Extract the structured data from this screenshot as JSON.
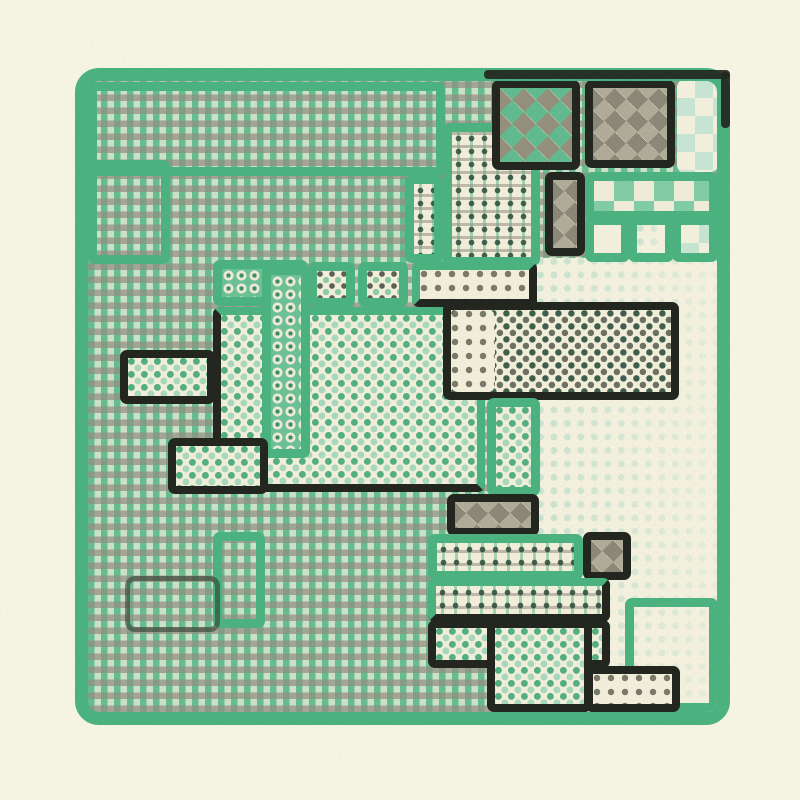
{
  "artwork": {
    "kind": "generative-riso-quilt",
    "description": "Abstract maze-like quilt of halftone pattern rooms inside a rounded green frame"
  },
  "canvas": {
    "width": 800,
    "height": 800,
    "background": "#fbf8e8"
  },
  "palette": {
    "page_cream": "#fbf8e8",
    "fill_cream": "#f6f2df",
    "frame_green": "#4db583",
    "mid_green": "#55b285",
    "light_green": "#a9dcc0",
    "faint_green": "#cde6d4",
    "warm_gray": "#9a958a",
    "ink_black": "#23271f",
    "deep_green": "#39604d"
  },
  "frame": {
    "x": 75,
    "y": 68,
    "w": 655,
    "h": 657,
    "border_width": 13,
    "radius": 24,
    "border_color": "#4db583",
    "base_pattern": "gingham"
  },
  "patterns": [
    "gingham",
    "windowpane",
    "dots-green",
    "dots-dkgreen",
    "dots-gray",
    "dots-dark",
    "dots-faint",
    "rings",
    "argyle-green",
    "argyle-gray",
    "checker-green",
    "checker-faint",
    "blank",
    "none"
  ],
  "regions": [
    {
      "name": "outline-room-top",
      "x": 88,
      "y": 82,
      "w": 357,
      "h": 94,
      "pattern": "none",
      "border": "green"
    },
    {
      "name": "outline-room-topleft",
      "x": 88,
      "y": 160,
      "w": 82,
      "h": 104,
      "pattern": "none",
      "border": "green"
    },
    {
      "name": "faint-dots-field",
      "x": 537,
      "y": 258,
      "w": 181,
      "h": 454,
      "pattern": "dots-faint",
      "border": "none"
    },
    {
      "name": "outline-room-bottomright",
      "x": 625,
      "y": 598,
      "w": 93,
      "h": 114,
      "pattern": "none",
      "border": "green"
    },
    {
      "name": "rings-band",
      "x": 213,
      "y": 260,
      "w": 95,
      "h": 46,
      "pattern": "rings",
      "border": "green"
    },
    {
      "name": "windowpane-room-left",
      "x": 405,
      "y": 175,
      "w": 38,
      "h": 88,
      "pattern": "windowpane",
      "border": "green"
    },
    {
      "name": "windowpane-room-main",
      "x": 443,
      "y": 123,
      "w": 97,
      "h": 143,
      "pattern": "windowpane",
      "border": "green"
    },
    {
      "name": "argyle-room-a",
      "x": 492,
      "y": 80,
      "w": 88,
      "h": 90,
      "pattern": "argyle-green",
      "border": "black"
    },
    {
      "name": "argyle-room-b",
      "x": 585,
      "y": 80,
      "w": 90,
      "h": 88,
      "pattern": "argyle-gray",
      "border": "black"
    },
    {
      "name": "checker-corner-strip",
      "x": 677,
      "y": 80,
      "w": 41,
      "h": 92,
      "pattern": "checker-faint",
      "border": "none"
    },
    {
      "name": "checker-row",
      "x": 585,
      "y": 172,
      "w": 133,
      "h": 48,
      "pattern": "checker-green",
      "border": "green"
    },
    {
      "name": "argyle-cell-a",
      "x": 545,
      "y": 172,
      "w": 40,
      "h": 84,
      "pattern": "argyle-gray",
      "border": "black"
    },
    {
      "name": "blank-cell",
      "x": 585,
      "y": 216,
      "w": 45,
      "h": 46,
      "pattern": "blank",
      "border": "green"
    },
    {
      "name": "faint-dots-cell",
      "x": 628,
      "y": 216,
      "w": 46,
      "h": 46,
      "pattern": "dots-faint",
      "border": "green"
    },
    {
      "name": "checker-cell-faint",
      "x": 672,
      "y": 216,
      "w": 46,
      "h": 46,
      "pattern": "checker-faint",
      "border": "green"
    },
    {
      "name": "dot-box-a",
      "x": 308,
      "y": 262,
      "w": 47,
      "h": 45,
      "pattern": "dots-dkgreen",
      "border": "green"
    },
    {
      "name": "dot-box-b",
      "x": 358,
      "y": 262,
      "w": 50,
      "h": 45,
      "pattern": "dots-dkgreen",
      "border": "green"
    },
    {
      "name": "dot-box-c",
      "x": 412,
      "y": 262,
      "w": 125,
      "h": 45,
      "pattern": "dots-gray",
      "border": "gb"
    },
    {
      "name": "center-dots-room",
      "x": 213,
      "y": 307,
      "w": 272,
      "h": 185,
      "pattern": "dots-green",
      "border": "gbb"
    },
    {
      "name": "rings-column",
      "x": 262,
      "y": 266,
      "w": 48,
      "h": 192,
      "pattern": "rings",
      "border": "green"
    },
    {
      "name": "left-dots-room-a",
      "x": 120,
      "y": 350,
      "w": 95,
      "h": 54,
      "pattern": "dots-green",
      "border": "black"
    },
    {
      "name": "left-dots-room-b",
      "x": 168,
      "y": 438,
      "w": 100,
      "h": 56,
      "pattern": "dots-green",
      "border": "black"
    },
    {
      "name": "dark-dots-room",
      "x": 443,
      "y": 302,
      "w": 236,
      "h": 98,
      "pattern": "dots-dark",
      "border": "black"
    },
    {
      "name": "gray-dots-cell",
      "x": 451,
      "y": 310,
      "w": 44,
      "h": 82,
      "pattern": "dots-gray",
      "border": "none"
    },
    {
      "name": "side-dots-room",
      "x": 487,
      "y": 398,
      "w": 53,
      "h": 98,
      "pattern": "dots-green",
      "border": "green"
    },
    {
      "name": "argyle-room-c",
      "x": 447,
      "y": 494,
      "w": 92,
      "h": 42,
      "pattern": "argyle-gray",
      "border": "black"
    },
    {
      "name": "windowpane-band-a",
      "x": 428,
      "y": 534,
      "w": 155,
      "h": 46,
      "pattern": "windowpane",
      "border": "green"
    },
    {
      "name": "argyle-cell-b",
      "x": 583,
      "y": 532,
      "w": 48,
      "h": 48,
      "pattern": "argyle-gray",
      "border": "black"
    },
    {
      "name": "windowpane-band-b",
      "x": 428,
      "y": 578,
      "w": 182,
      "h": 44,
      "pattern": "windowpane",
      "border": "gb"
    },
    {
      "name": "bottom-dots-room-a",
      "x": 428,
      "y": 620,
      "w": 182,
      "h": 48,
      "pattern": "dots-green",
      "border": "black"
    },
    {
      "name": "bottom-dots-room-b",
      "x": 487,
      "y": 620,
      "w": 105,
      "h": 92,
      "pattern": "dots-green",
      "border": "black"
    },
    {
      "name": "gray-dots-box",
      "x": 585,
      "y": 666,
      "w": 95,
      "h": 46,
      "pattern": "dots-gray",
      "border": "black"
    },
    {
      "name": "outline-room-bottomleft-a",
      "x": 213,
      "y": 532,
      "w": 52,
      "h": 96,
      "pattern": "none",
      "border": "green"
    },
    {
      "name": "outline-room-bottomleft-b",
      "x": 125,
      "y": 576,
      "w": 95,
      "h": 56,
      "pattern": "none",
      "border": "darkline"
    }
  ],
  "accents": [
    {
      "name": "frame-accent-top",
      "x": 484,
      "y": 70,
      "w": 246,
      "h": 9
    },
    {
      "name": "frame-accent-right",
      "x": 721,
      "y": 72,
      "w": 9,
      "h": 56
    }
  ]
}
